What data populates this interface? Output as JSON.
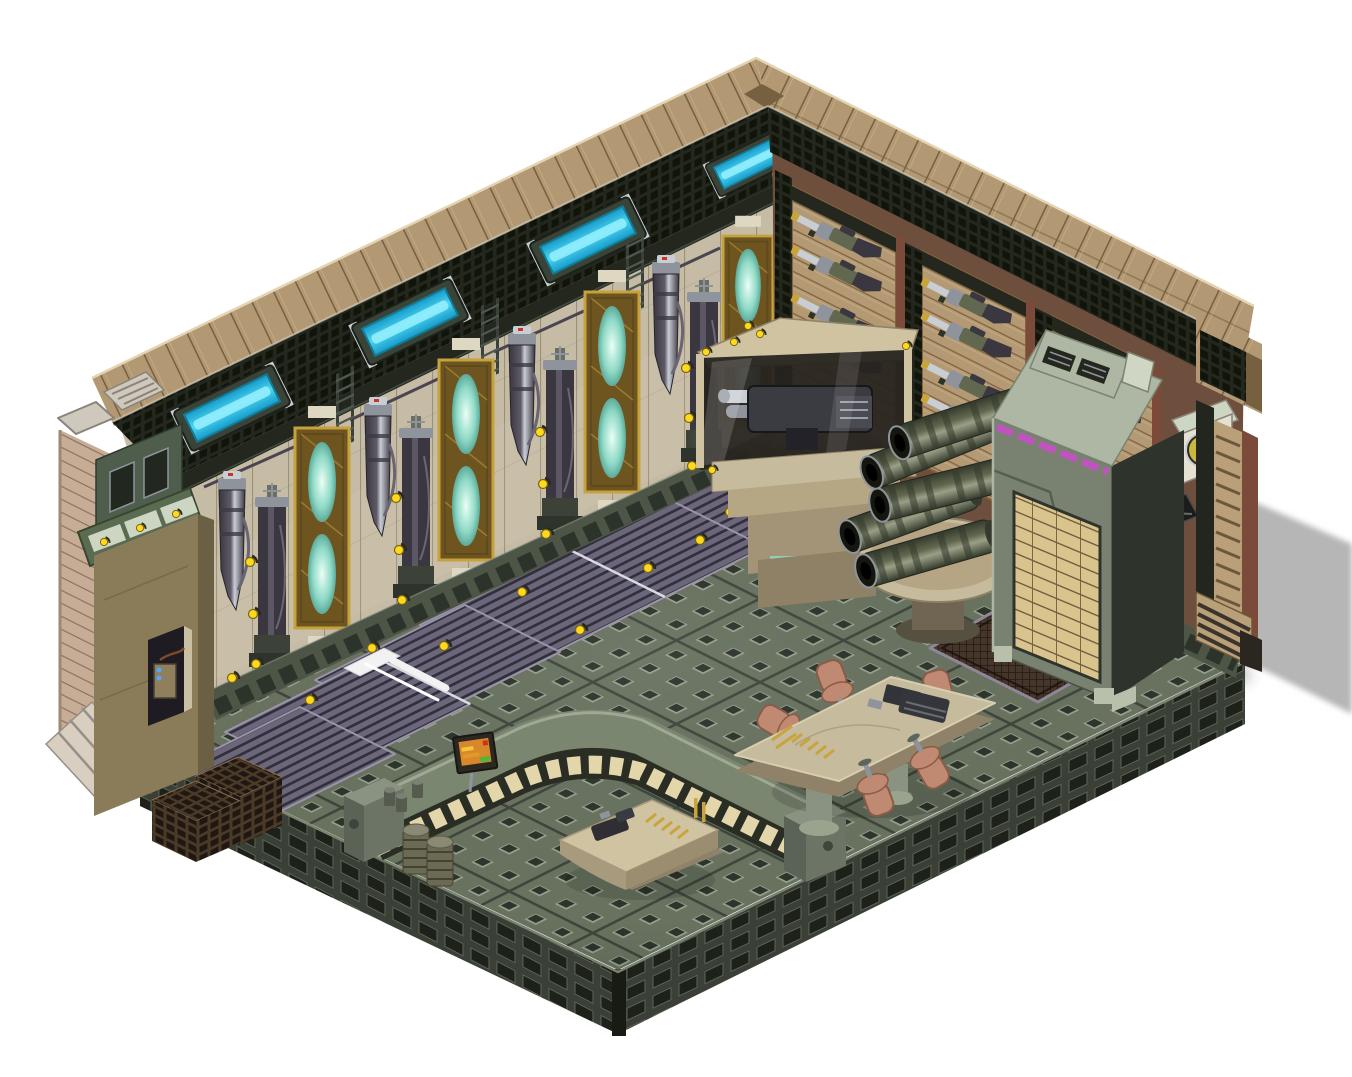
{
  "meta": {
    "title": "Isometric sci-fi armory room",
    "style": "pre-rendered isometric game art on white background",
    "canvas": {
      "width": 1352,
      "height": 1077
    }
  },
  "palette": {
    "bg": "#ffffff",
    "shadowGrey": "#b6b6b6",
    "roofTan": "#b29873",
    "roofSeam": "#77603f",
    "roofLight": "#d8c5a0",
    "meshDark": "#23271e",
    "meshHole": "#101409",
    "cyanCore": "#49d6f2",
    "cyanMid": "#1899c9",
    "cyanGlow": "#9ef2ff",
    "wallPanelLight": "#c6bba4",
    "wallShade": "#8d8269",
    "wallTanR": "#b49a74",
    "slatShade": "#86643f",
    "rustPillar": "#7c4a38",
    "rustBase": "#6e4f3e",
    "goldFrame": "#c5a23e",
    "goldDark": "#6e5520",
    "tealGlow": "#8fd9c6",
    "tealPale": "#eafff6",
    "tealDark": "#3e8f80",
    "gunmetal": "#5e5966",
    "gunmetalDark": "#3a3740",
    "silver": "#c9ced4",
    "silverDark": "#8f939c",
    "skirt": "#4c5546",
    "skirtDark": "#2c332a",
    "floorBase": "#68725f",
    "floorSeam": "#3e463c",
    "studDark": "#2d342b",
    "studLight": "#98a190",
    "platSide": "#3a4036",
    "platBlock": "#1d211a",
    "platEdge": "#5c665a",
    "matBase": "#6b667a",
    "matStripe": "#322f3c",
    "matEdge": "#9a94a8",
    "counterTop": "#7b8671",
    "counterTopEdge": "#a8b29c",
    "counterFace": "#2a2d24",
    "windowCream": "#ecdfb2",
    "trimOrange": "#c87f2e",
    "tableTan": "#c6bb9c",
    "tableEdge": "#8f8268",
    "chairCopper": "#c08a72",
    "chairShadow": "#8a5b48",
    "cabinetFace": "#798271",
    "cabinetSide": "#2e332c",
    "cabinetTop": "#aeb7a4",
    "magenta": "#c84fc8",
    "ammoTan": "#d9c48e",
    "ammoGap": "#6e5f3f",
    "barrelOlive": "#62684f",
    "barrelLight": "#9aa086",
    "barrelDark": "#343a2c",
    "muzzle": "#15170f",
    "glowWarm": "#f7e3b0",
    "yellowDot": "#ffd91e",
    "benchTan": "#cfc3a2",
    "brass": "#c9a33c",
    "screenOrange": "#d8872b",
    "screenRed": "#cc3322",
    "screenGreen": "#53b43c",
    "grateBrown": "#46352a",
    "grateDark": "#241a12",
    "grateRim": "#8d8799",
    "stepBrown": "#4a3a28",
    "stepDark": "#201712",
    "kioskTan": "#8a7c58",
    "kioskGreen": "#4e5d4c",
    "glassPale": "#cdd6c2",
    "exTan": "#c7ad96",
    "exStripe": "#8a6f5c",
    "blueLed": "#4aa8ff",
    "white": "#f2f2f2"
  },
  "scene": {
    "background": "#ffffff",
    "room": "L-shaped two-wall isometric armory interior on a raised studded metal platform, shadow cast to the right",
    "left_wall": {
      "roof_light_panels": {
        "count": 4,
        "color": "cyan",
        "mounted_in": "dark mesh band under tan plank roof"
      },
      "glow_tube_panels": {
        "count": 4,
        "frame": "gold",
        "glow": "pale teal ovals"
      },
      "hanging_gun_columns": {
        "count": 5
      },
      "standing_tower_machines": {
        "count": 4
      },
      "ladders": {
        "count": 3
      },
      "indicator_lights": {
        "color": "yellow",
        "count": 22
      }
    },
    "right_wall": {
      "rifle_racks": {
        "count": 3,
        "rifles_total": 10,
        "rifle_colors": [
          "olive",
          "silver",
          "dark stock"
        ]
      },
      "materials": [
        "tan slat panels",
        "rust-red pillars",
        "dark mesh columns"
      ]
    },
    "objects": [
      {
        "name": "display-case",
        "desc": "glass display case on tan pedestal holding a heavy machine gun, warm interior light, yellow marker dots"
      },
      {
        "name": "barrel-table",
        "desc": "round tan pedestal table stacked with five large ribbed cannon barrels",
        "barrels": 5
      },
      {
        "name": "ammo-cabinet",
        "desc": "tall grey-green cabinet, sloped vented top, magenta trim stripes, tan ammo-crate rack on front face"
      },
      {
        "name": "porthole-gauge",
        "desc": "wall-mounted device with round yellow split porthole"
      },
      {
        "name": "wall-bracket",
        "desc": "black X-braced wall bracket"
      },
      {
        "name": "workbench-counter",
        "desc": "curved counter, grey-green top, dark front with glowing cream window panels and orange trim"
      },
      {
        "name": "counter-sign",
        "desc": "small monitor sign with orange screen, red and green indicators"
      },
      {
        "name": "weapon-bench",
        "desc": "small tan saddle bench with disassembled gun parts and brass cartridges"
      },
      {
        "name": "briefing-table",
        "desc": "tan rounded table with weapon parts, dark keypad and brass ammunition rows"
      },
      {
        "name": "chairs",
        "desc": "copper sheet-metal chairs around the table",
        "count": 5
      },
      {
        "name": "floor-mats",
        "desc": "ribbed purple-grey mats laid in a stepped diagonal row",
        "count": 6
      },
      {
        "name": "white-strip",
        "desc": "white strip object lying across a mat"
      },
      {
        "name": "floor-grate",
        "desc": "dark rust ventilation grate set into the floor by the cabinet"
      },
      {
        "name": "step-block",
        "desc": "dark brown stepped grid block at the lower-left platform edge"
      },
      {
        "name": "storage-barrels",
        "desc": "two ribbed storage barrels and small canisters by the counter end",
        "count": 2
      },
      {
        "name": "kiosk-tower",
        "desc": "tan corner tower with green cabinet, sloped glass cell panel and service window with blue-lit machine"
      },
      {
        "name": "exterior-steps",
        "desc": "small stairs at the right exterior wall end"
      }
    ]
  }
}
